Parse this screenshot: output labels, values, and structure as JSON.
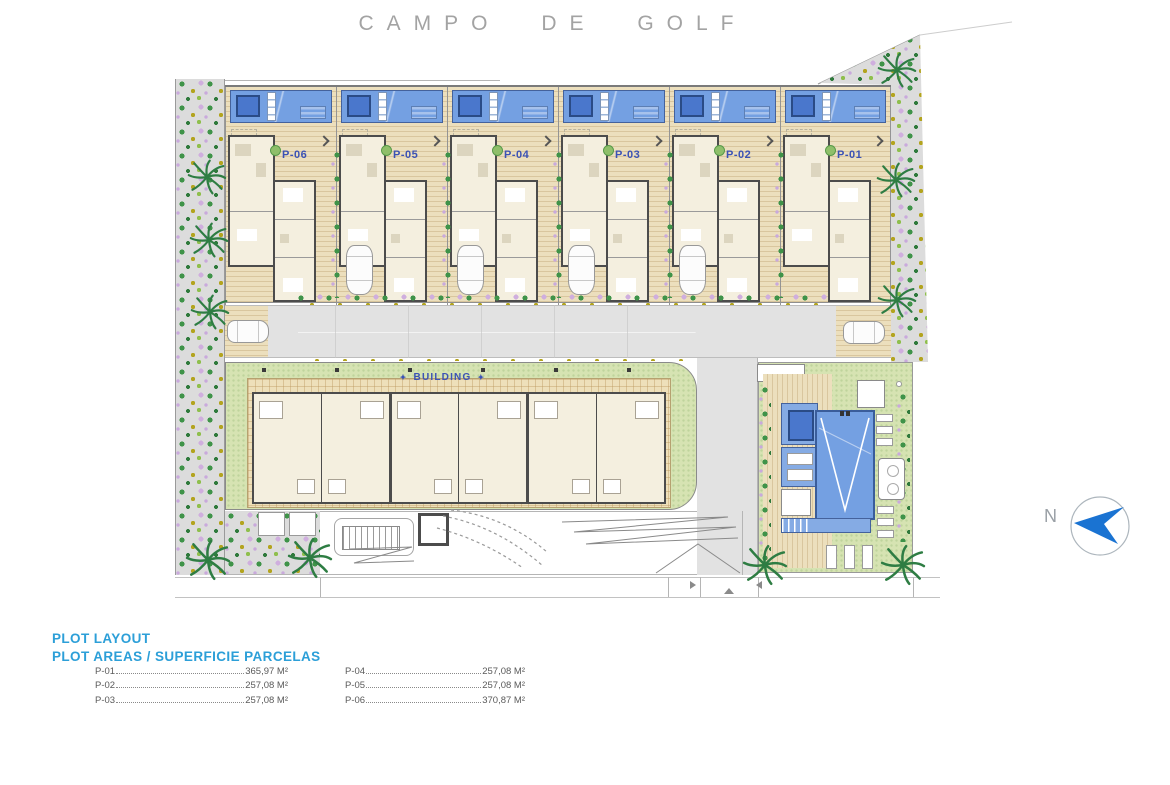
{
  "title": "CAMPO DE GOLF",
  "site": {
    "units": [
      {
        "label": "P-06"
      },
      {
        "label": "P-05"
      },
      {
        "label": "P-04"
      },
      {
        "label": "P-03"
      },
      {
        "label": "P-02"
      },
      {
        "label": "P-01"
      }
    ],
    "building": {
      "label": "BUILDING",
      "ornament": "✦"
    },
    "north_label": "N"
  },
  "legend": {
    "heading1": "PLOT LAYOUT",
    "heading2": "PLOT AREAS / SUPERFICIE PARCELAS",
    "columns": [
      [
        {
          "id": "P-01",
          "area": "365,97 M²"
        },
        {
          "id": "P-02",
          "area": "257,08 M²"
        },
        {
          "id": "P-03",
          "area": "257,08 M²"
        }
      ],
      [
        {
          "id": "P-04",
          "area": "257,08 M²"
        },
        {
          "id": "P-05",
          "area": "257,08 M²"
        },
        {
          "id": "P-06",
          "area": "370,87 M²"
        }
      ]
    ]
  },
  "colors": {
    "legend_blue": "#2c9fd8",
    "plot_label_blue": "#3b52b5",
    "pool_blue": "#74a0e2",
    "north_arrow_blue": "#1a73d2",
    "grass_green": "#d6e3b2",
    "deck_tan": "#e7dab6",
    "road_gray": "#e2e2e2"
  }
}
